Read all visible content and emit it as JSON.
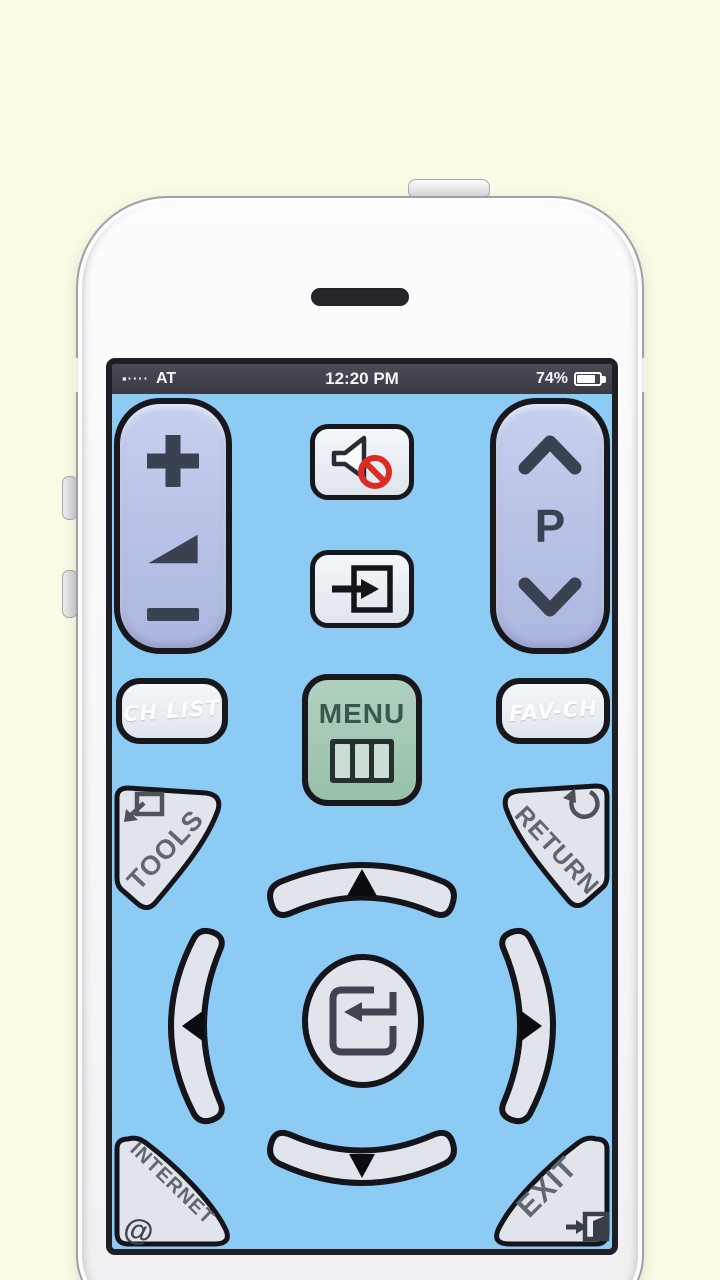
{
  "statusbar": {
    "signal": "▪····",
    "carrier": "AT",
    "time": "12:20 PM",
    "battery": "74%"
  },
  "remote": {
    "channel_label": "P",
    "ch_list": "CH LIST",
    "menu": "MENU",
    "fav_ch": "FAV-CH",
    "tools": "TOOLS",
    "return": "RETURN",
    "internet": "INTERNET",
    "internet_at": "@",
    "exit": "EXIT",
    "icons": {
      "volume_up": "plus-icon",
      "volume_level": "volume-wedge-icon",
      "volume_down": "minus-icon",
      "channel_up": "chevron-up-icon",
      "channel_down": "chevron-down-icon",
      "mute": "speaker-mute-icon",
      "source": "input-source-icon",
      "menu": "menu-grid-icon",
      "tools": "popup-window-icon",
      "return": "rotate-ccw-icon",
      "enter": "enter-return-icon",
      "dpad_up": "up-triangle-icon",
      "dpad_down": "down-triangle-icon",
      "dpad_left": "left-triangle-icon",
      "dpad_right": "right-triangle-icon",
      "exit": "exit-door-icon"
    },
    "colors": {
      "screen_bg": "#8CCBF3",
      "rocker": "#B9C2E6",
      "key": "#E2E7EE",
      "menu_green": "#A3C9B5",
      "mute_slash": "#DC2B26",
      "outline": "#17171C",
      "background": "#FCFBE6"
    }
  }
}
